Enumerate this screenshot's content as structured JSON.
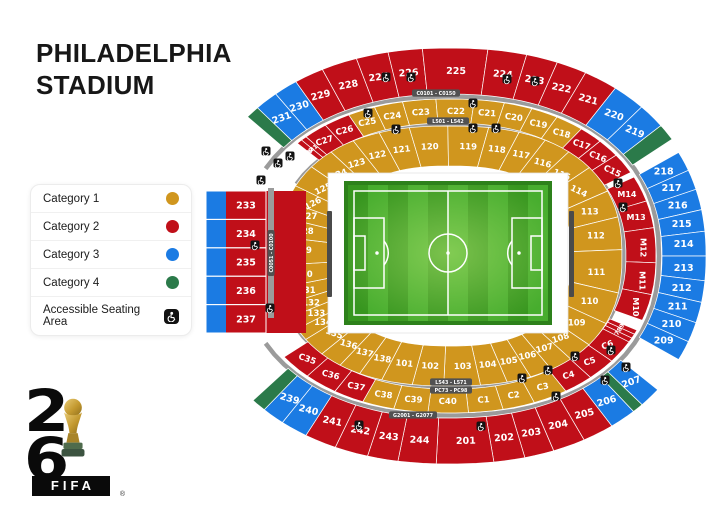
{
  "page": {
    "title_line1": "PHILADELPHIA",
    "title_line2": "STADIUM"
  },
  "legend": {
    "items": [
      {
        "id": "category-1",
        "label": "Category 1",
        "color": "#D0961E",
        "type": "dot"
      },
      {
        "id": "category-2",
        "label": "Category 2",
        "color": "#C00F19",
        "type": "dot"
      },
      {
        "id": "category-3",
        "label": "Category 3",
        "color": "#1B7BE3",
        "type": "dot"
      },
      {
        "id": "category-4",
        "label": "Category 4",
        "color": "#2B7A4A",
        "type": "dot"
      },
      {
        "id": "accessible",
        "label": "Accessible Seating Area",
        "type": "wheelchair-icon"
      }
    ]
  },
  "logo": {
    "digit_top": "2",
    "digit_bottom": "6",
    "wordmark": "FIFA",
    "registered": "®"
  },
  "colors": {
    "cat1": "#D0961E",
    "cat2": "#C00F19",
    "cat3": "#1B7BE3",
    "cat4": "#2B7A4A",
    "walkway": "#9B9B9B",
    "chip": "#515151",
    "pitch_frame": "#2D811B",
    "pitch_dark": "#37961F",
    "pitch_light": "#47AD2E",
    "pitch_line": "#FFFFFF",
    "bench": "#4A4A4A"
  },
  "map": {
    "bands": {
      "top_outer": "C0101 - C0150",
      "top_inner": "L501 - L542",
      "bottom_inner_1": "L543 - L571",
      "bottom_inner_2": "PC73 - PC98",
      "bottom_outer": "G2001 - G2077",
      "left": "C0051 - C0100"
    },
    "rings": {
      "outer_top": [
        {
          "label": "",
          "cat": 4,
          "w": 3
        },
        {
          "label": "231",
          "cat": 3,
          "w": 5
        },
        {
          "label": "230",
          "cat": 3,
          "w": 5
        },
        {
          "label": "229",
          "cat": 2,
          "w": 6
        },
        {
          "label": "228",
          "cat": 2,
          "w": 7
        },
        {
          "label": "227",
          "cat": 2,
          "w": 6
        },
        {
          "label": "226",
          "cat": 2,
          "w": 6
        },
        {
          "label": "225",
          "cat": 2,
          "w": 10
        },
        {
          "label": "224",
          "cat": 2,
          "w": 7
        },
        {
          "label": "223",
          "cat": 2,
          "w": 6
        },
        {
          "label": "222",
          "cat": 2,
          "w": 6
        },
        {
          "label": "221",
          "cat": 2,
          "w": 7
        },
        {
          "label": "220",
          "cat": 3,
          "w": 7
        },
        {
          "label": "219",
          "cat": 3,
          "w": 6
        },
        {
          "label": "",
          "cat": 4,
          "w": 4
        }
      ],
      "outer_right": [
        {
          "label": "218",
          "cat": 3,
          "w": 1
        },
        {
          "label": "217",
          "cat": 3,
          "w": 1
        },
        {
          "label": "216",
          "cat": 3,
          "w": 1
        },
        {
          "label": "215",
          "cat": 3,
          "w": 1
        },
        {
          "label": "214",
          "cat": 3,
          "w": 1
        },
        {
          "label": "213",
          "cat": 3,
          "w": 1
        },
        {
          "label": "212",
          "cat": 3,
          "w": 1
        },
        {
          "label": "211",
          "cat": 3,
          "w": 1
        },
        {
          "label": "210",
          "cat": 3,
          "w": 1
        },
        {
          "label": "209",
          "cat": 3,
          "w": 1
        }
      ],
      "outer_bottom": [
        {
          "label": "207",
          "cat": 3,
          "w": 6
        },
        {
          "label": "",
          "cat": 4,
          "w": 3
        },
        {
          "label": "206",
          "cat": 3,
          "w": 7
        },
        {
          "label": "205",
          "cat": 2,
          "w": 8
        },
        {
          "label": "204",
          "cat": 2,
          "w": 8
        },
        {
          "label": "203",
          "cat": 2,
          "w": 7
        },
        {
          "label": "202",
          "cat": 2,
          "w": 7
        },
        {
          "label": "201",
          "cat": 2,
          "w": 11
        },
        {
          "label": "244",
          "cat": 2,
          "w": 8
        },
        {
          "label": "243",
          "cat": 2,
          "w": 7
        },
        {
          "label": "242",
          "cat": 2,
          "w": 8
        },
        {
          "label": "241",
          "cat": 2,
          "w": 8
        },
        {
          "label": "240",
          "cat": 3,
          "w": 7
        },
        {
          "label": "239",
          "cat": 3,
          "w": 6
        },
        {
          "label": "",
          "cat": 4,
          "w": 4
        }
      ],
      "mid_top": [
        {
          "label": "M2",
          "cat": 2,
          "w": 1.5
        },
        {
          "label": "M1",
          "cat": 2,
          "w": 1.5
        },
        {
          "label": "C27",
          "cat": 2,
          "w": 6
        },
        {
          "label": "C26",
          "cat": 2,
          "w": 6.5
        },
        {
          "label": "C25",
          "cat": 1,
          "w": 6.5
        },
        {
          "label": "C24",
          "cat": 1,
          "w": 6.5
        },
        {
          "label": "C23",
          "cat": 1,
          "w": 7
        },
        {
          "label": "C22",
          "cat": 1,
          "w": 7
        },
        {
          "label": "C21",
          "cat": 1,
          "w": 6.5
        },
        {
          "label": "C20",
          "cat": 1,
          "w": 6.5
        },
        {
          "label": "C19",
          "cat": 1,
          "w": 6.5
        },
        {
          "label": "C18",
          "cat": 1,
          "w": 7
        },
        {
          "label": "C17",
          "cat": 2,
          "w": 6
        },
        {
          "label": "C16",
          "cat": 2,
          "w": 6
        },
        {
          "label": "C15",
          "cat": 2,
          "w": 6.5
        }
      ],
      "mid_right": [
        {
          "label": "M14",
          "cat": 2,
          "w": 1
        },
        {
          "label": "M13",
          "cat": 2,
          "w": 1
        },
        {
          "label": "M12",
          "cat": 2,
          "w": 1.1
        },
        {
          "label": "M11",
          "cat": 2,
          "w": 1.1
        },
        {
          "label": "M10",
          "cat": 2,
          "w": 1
        }
      ],
      "mid_bottom": [
        {
          "label": "M9",
          "cat": 2,
          "w": 1.5
        },
        {
          "label": "M8",
          "cat": 2,
          "w": 1.5
        },
        {
          "label": "M7",
          "cat": 2,
          "w": 1.5
        },
        {
          "label": "C6",
          "cat": 2,
          "w": 8
        },
        {
          "label": "C5",
          "cat": 2,
          "w": 8
        },
        {
          "label": "C4",
          "cat": 2,
          "w": 8
        },
        {
          "label": "C3",
          "cat": 1,
          "w": 9
        },
        {
          "label": "C2",
          "cat": 1,
          "w": 8
        },
        {
          "label": "C1",
          "cat": 1,
          "w": 8
        },
        {
          "label": "C40",
          "cat": 1,
          "w": 8
        },
        {
          "label": "C39",
          "cat": 1,
          "w": 8
        },
        {
          "label": "C38",
          "cat": 1,
          "w": 8
        },
        {
          "label": "C37",
          "cat": 2,
          "w": 8
        },
        {
          "label": "C36",
          "cat": 2,
          "w": 9
        },
        {
          "label": "C35",
          "cat": 2,
          "w": 9
        }
      ],
      "inner": [
        {
          "label": "134",
          "cat": 1,
          "w": 5.5
        },
        {
          "label": "133",
          "cat": 1,
          "w": 5.5
        },
        {
          "label": "132",
          "cat": 1,
          "w": 5.5
        },
        {
          "label": "131",
          "cat": 1,
          "w": 6.5
        },
        {
          "label": "130",
          "cat": 1,
          "w": 7.5
        },
        {
          "label": "129",
          "cat": 1,
          "w": 7.5
        },
        {
          "label": "128",
          "cat": 1,
          "w": 7
        },
        {
          "label": "127",
          "cat": 1,
          "w": 6.5
        },
        {
          "label": "126",
          "cat": 1,
          "w": 7
        },
        {
          "label": "125",
          "cat": 1,
          "w": 10
        },
        {
          "label": "124",
          "cat": 1,
          "w": 9.5
        },
        {
          "label": "123",
          "cat": 1,
          "w": 9
        },
        {
          "label": "122",
          "cat": 1,
          "w": 9
        },
        {
          "label": "121",
          "cat": 1,
          "w": 9
        },
        {
          "label": "120",
          "cat": 1,
          "w": 9
        },
        {
          "label": "119",
          "cat": 1,
          "w": 9
        },
        {
          "label": "118",
          "cat": 1,
          "w": 9
        },
        {
          "label": "117",
          "cat": 1,
          "w": 9
        },
        {
          "label": "116",
          "cat": 1,
          "w": 9.5
        },
        {
          "label": "115",
          "cat": 1,
          "w": 10
        },
        {
          "label": "114",
          "cat": 1,
          "w": 12
        },
        {
          "label": "113",
          "cat": 1,
          "w": 11
        },
        {
          "label": "112",
          "cat": 1,
          "w": 11
        },
        {
          "label": "111",
          "cat": 1,
          "w": 13
        },
        {
          "label": "110",
          "cat": 1,
          "w": 13
        },
        {
          "label": "109",
          "cat": 1,
          "w": 11
        },
        {
          "label": "108",
          "cat": 1,
          "w": 9
        },
        {
          "label": "107",
          "cat": 1,
          "w": 8
        },
        {
          "label": "106",
          "cat": 1,
          "w": 7.5
        },
        {
          "label": "105",
          "cat": 1,
          "w": 7.5
        },
        {
          "label": "104",
          "cat": 1,
          "w": 7.5
        },
        {
          "label": "103",
          "cat": 1,
          "w": 7.5
        },
        {
          "label": "102",
          "cat": 1,
          "w": 7.5
        },
        {
          "label": "101",
          "cat": 1,
          "w": 9
        },
        {
          "label": "138",
          "cat": 1,
          "w": 7.5
        },
        {
          "label": "137",
          "cat": 1,
          "w": 7.5
        },
        {
          "label": "136",
          "cat": 1,
          "w": 8
        },
        {
          "label": "135",
          "cat": 1,
          "w": 8.5
        }
      ]
    },
    "left_block": {
      "strip_cat": 3,
      "rows": [
        "233",
        "234",
        "235",
        "236",
        "237"
      ]
    }
  }
}
